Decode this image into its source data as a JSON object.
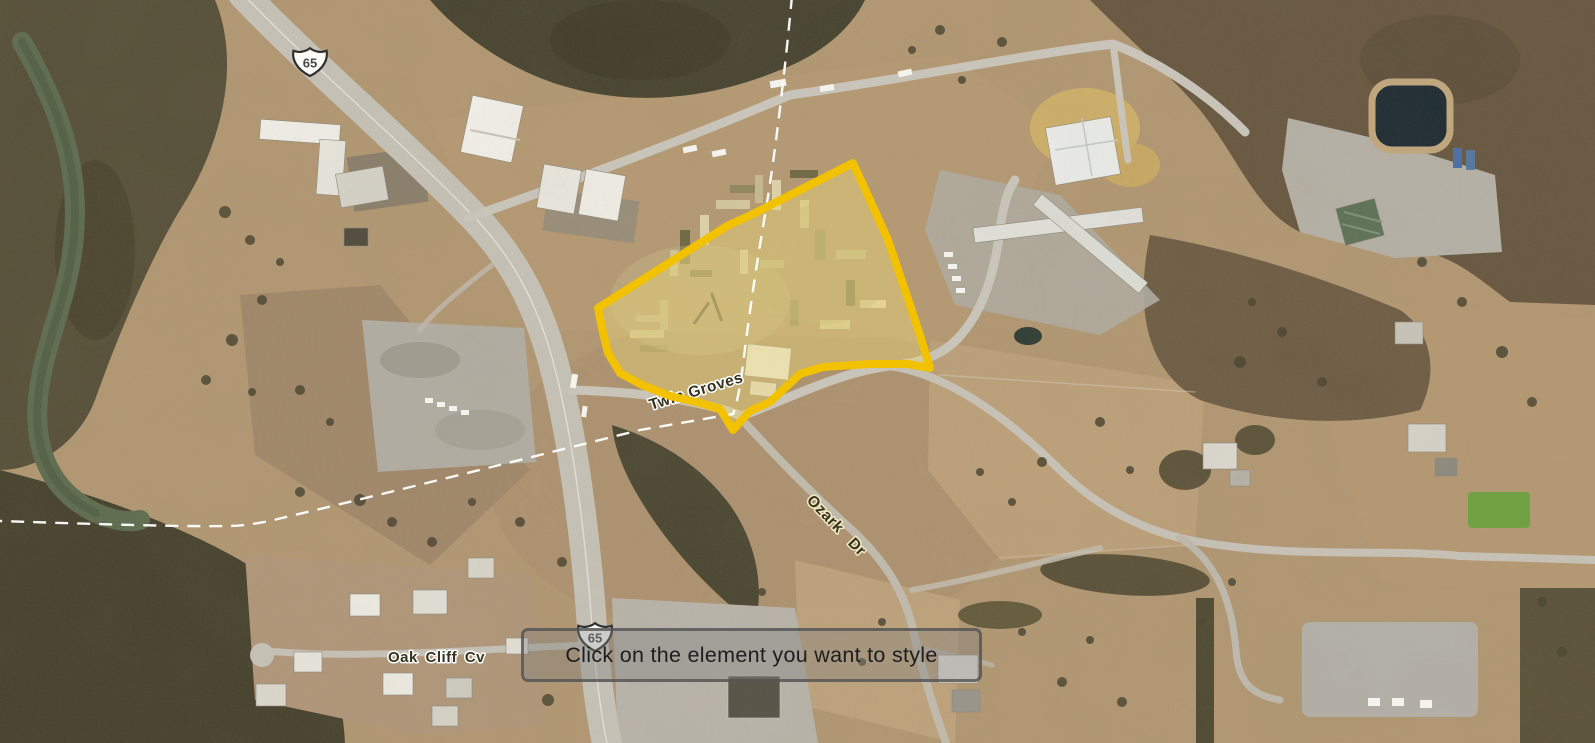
{
  "map": {
    "type": "aerial-satellite",
    "road_labels": {
      "shield_top": "65",
      "shield_bottom": "65",
      "twin_groves": "Twin Groves",
      "ozark_dr": "Ozark Dr",
      "oak_cliff_cv": "Oak Cliff Cv"
    },
    "parcel_highlight": {
      "stroke_color": "#F2C100",
      "fill_color": "#E9D478"
    },
    "boundary_line_color": "#FFFFFF"
  },
  "tooltip": {
    "text": "Click on the element you want to style"
  }
}
